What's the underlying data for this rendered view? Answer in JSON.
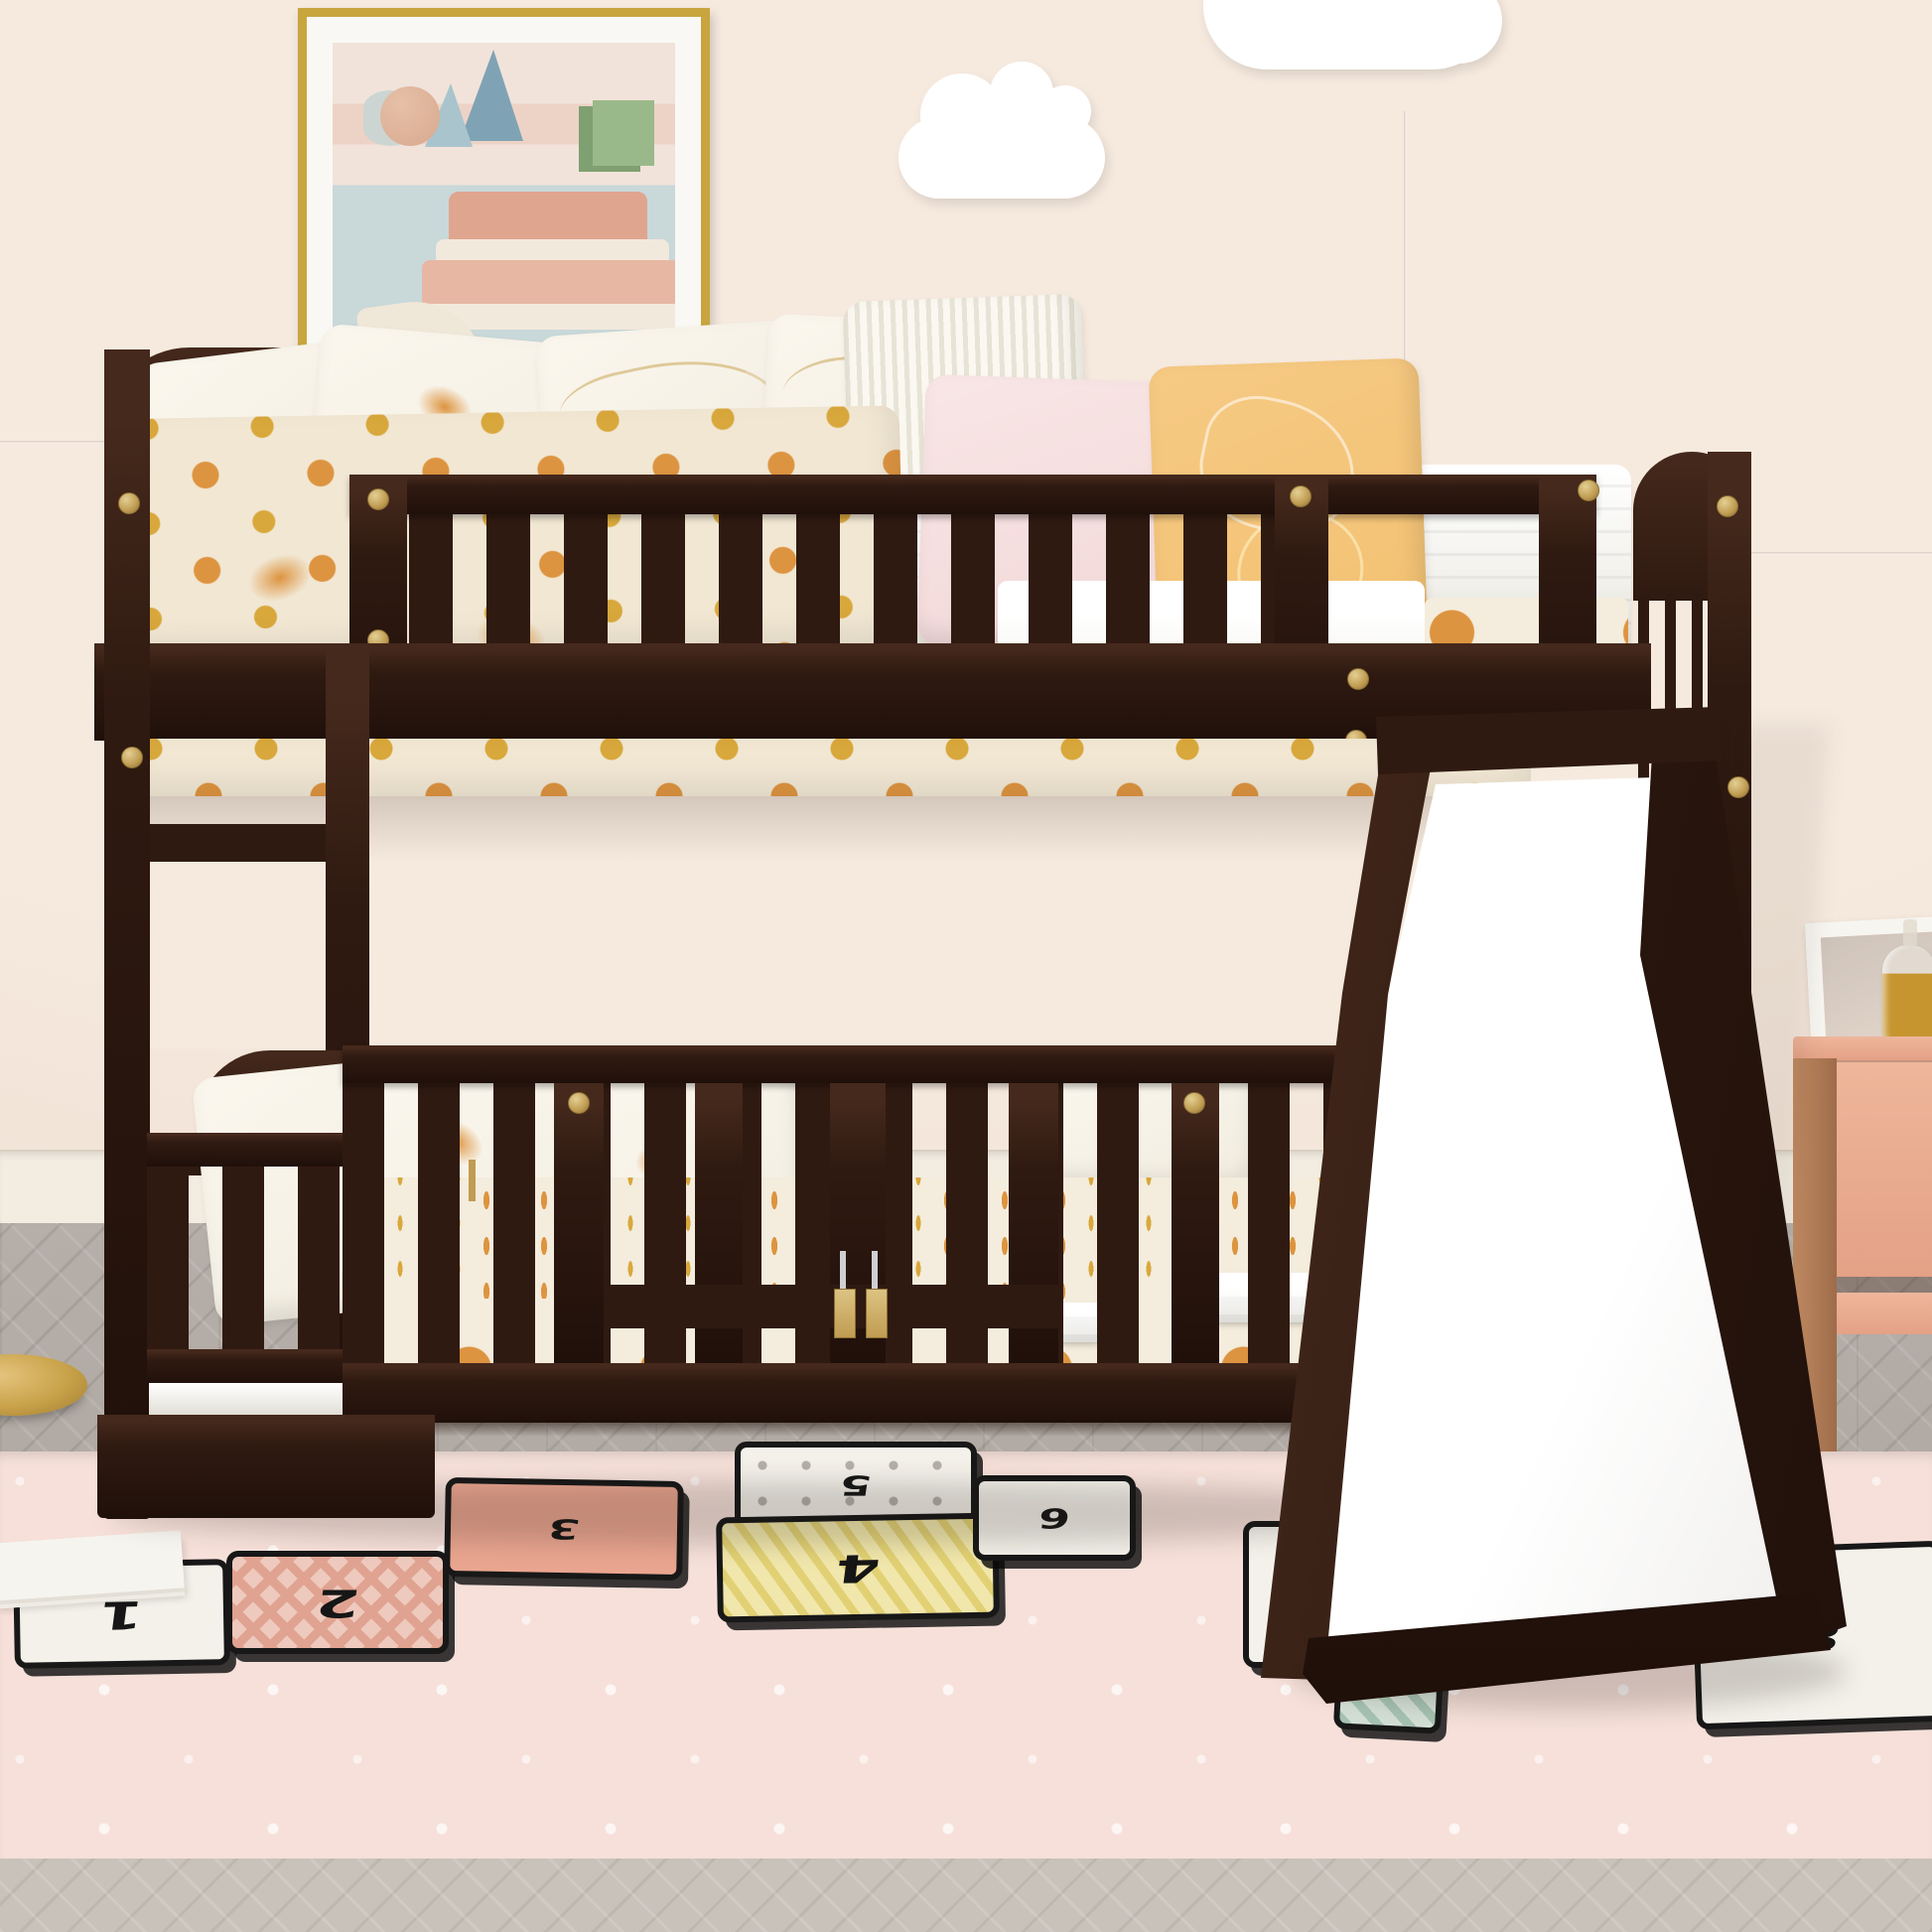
{
  "scene": {
    "kind": "children bedroom product photo",
    "subject": "espresso twin-over-twin low bunk bed with guardrails, ladder, safety-gate fence and white slide"
  },
  "palette": {
    "wall": "#f6eadf",
    "wallDeep": "#efddd0",
    "wallSeam": "#ddccc0",
    "baseboard": "#f2ece1",
    "baseboardEdge": "#d9d0c2",
    "floor": "#b6afa9",
    "floorDeep": "#a8a19b",
    "floorFront": "#c9c2ba",
    "frameGold": "#c9a53f",
    "artMat": "#faf8f4",
    "artSky": "#c9d8d9",
    "artBand1": "#f1e3da",
    "artBand2": "#edd3c6",
    "artPyramid": "#7fa3b5",
    "artPyramidL": "#a9c4cd",
    "artBall": "#d8a98e",
    "artCyl": "#ccd5d2",
    "artCubeTop": "#9ab98a",
    "artCubeSide": "#7fa070",
    "artCake1": "#dfa58f",
    "artCake2": "#e7b7a4",
    "artPlate": "#f2e9dd",
    "artDome": "#efe7d8",
    "cloud": "#ffffff",
    "wood": "#2f1a11",
    "woodDark": "#20100a",
    "woodLight": "#45291c",
    "gold": "#c09c52",
    "goldDark": "#8a6f33",
    "silver": "#cfcfd2",
    "mattress": "#f2f1ec",
    "mattressShade": "#d9d6cc",
    "blanket": "#f1e7d3",
    "dotOrange": "#dd9440",
    "dashGold": "#d9a83c",
    "pillowWhite": "#f1ecdf",
    "pillowStripe": "#e7e3d6",
    "pillowPink": "#f2d7d8",
    "pillowYellow": "#f2c070",
    "slideShade": "#e9e7e4",
    "rug": "#f6e0d9",
    "patchInk": "#181818",
    "patchWhite": "#f4f1ea",
    "patchPinkTri": "#eec9bd",
    "patchPinkTriDark": "#e0a391",
    "patchSalmon": "#e9a58f",
    "patchYellow": "#f1e7ac",
    "patchYellowStripe": "#e2d174",
    "patchDotInk": "#b4afa8",
    "patchGreen": "#d3dfd5",
    "patchGreenDark": "#a6c2b1",
    "nstandPink": "#eeb69b",
    "nstandPinkDark": "#e4a186",
    "nstandWood": "#c08a62",
    "nstandWoodDark": "#9e6c4a",
    "glassGold": "#c6952f",
    "lampGold": "#c9a24a",
    "lampGoldDark": "#a07c2f",
    "book": "#f6f4ef"
  },
  "rug": {
    "style": "hopscotch play rug",
    "patches": [
      {
        "number": "1",
        "style": "white"
      },
      {
        "number": "2",
        "style": "pink-triangles"
      },
      {
        "number": "3",
        "style": "salmon"
      },
      {
        "number": "4",
        "style": "yellow-stripes"
      },
      {
        "number": "5",
        "style": "grey-dots"
      },
      {
        "number": "6",
        "style": "white"
      },
      {
        "number": "7",
        "style": "white"
      },
      {
        "number": "8",
        "style": "white"
      },
      {
        "number": "",
        "style": "green-triangles"
      }
    ]
  }
}
